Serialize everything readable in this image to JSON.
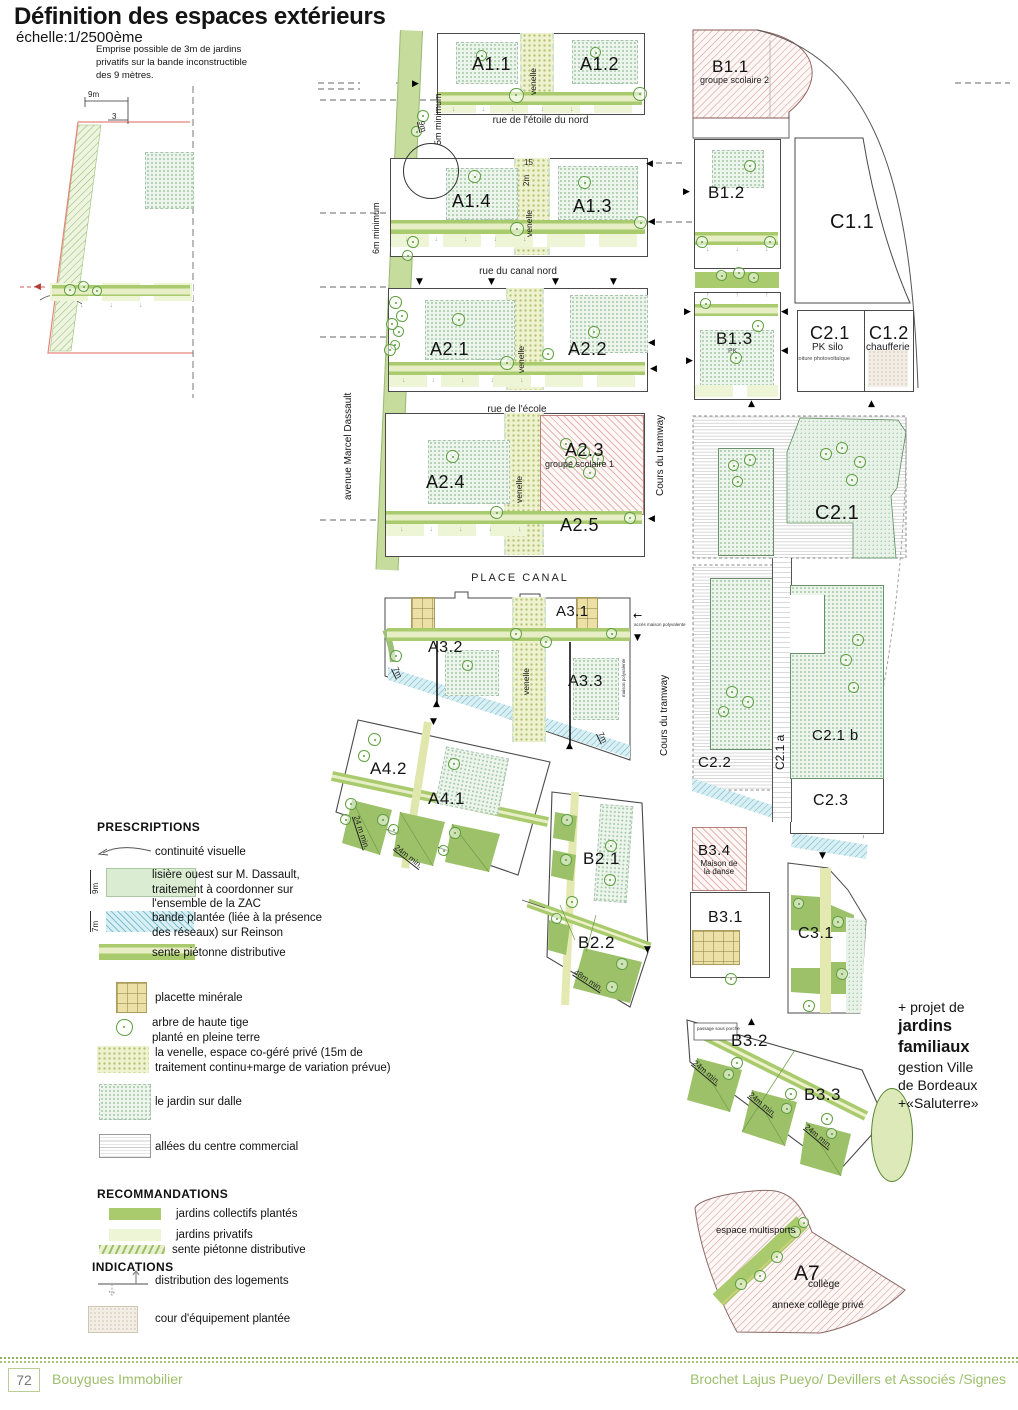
{
  "header": {
    "title": "Définition des espaces extérieurs",
    "scale": "échelle:1/2500ème",
    "note": "Emprise possible de 3m de jardins\nprivatifs sur la bande inconstructible\ndes 9 mètres."
  },
  "inset": {
    "dim_9m": "9m",
    "dim_3": "3"
  },
  "plan": {
    "venelle_label": "venelle",
    "streets": {
      "etoile": "rue de l'étoile du nord",
      "canal": "rue du canal nord",
      "ecole": "rue de l'école",
      "place": "PLACE CANAL",
      "dassault": "avenue Marcel Dassault",
      "tramway": "Cours du tramway"
    },
    "dims": {
      "min5": "5m minimum",
      "min6": "6m minimum",
      "m9": "9m",
      "v15": "15",
      "v2m": "2m",
      "m7": "7m",
      "d24a": "24 m min.",
      "d24b": "24m min.",
      "d48": "48m min."
    },
    "zones": {
      "a11": "A1.1",
      "a12": "A1.2",
      "b11": "B1.1",
      "b11_sub": "groupe scolaire 2",
      "a14": "A1.4",
      "a13": "A1.3",
      "b12": "B1.2",
      "c11": "C1.1",
      "a21": "A2.1",
      "a22": "A2.2",
      "b13": "B1.3",
      "b13_sub": "PK",
      "c21s": "C2.1",
      "c21s_sub1": "PK silo",
      "c21s_sub2": "toiture photovoltaïque",
      "c12": "C1.2",
      "c12_sub": "chaufferie",
      "a24": "A2.4",
      "a23": "A2.3",
      "a23_sub": "groupe scolaire 1",
      "a25": "A2.5",
      "c21": "C2.1",
      "a31": "A3.1",
      "a32": "A3.2",
      "a33": "A3.3",
      "c22": "C2.2",
      "c21a": "C2.1 a",
      "c21b": "C2.1 b",
      "c23": "C2.3",
      "a42": "A4.2",
      "a41": "A4.1",
      "b21": "B2.1",
      "b22": "B2.2",
      "b34": "B3.4",
      "b34_sub": "Maison de\nla danse",
      "b31": "B3.1",
      "c31": "C3.1",
      "b32": "B3.2",
      "b33": "B3.3",
      "a7": "A7",
      "a7_sub1": "collège",
      "a7_sub2": "annexe collège privé",
      "multisports": "espace multisports"
    },
    "tiny": {
      "acces": "accès maison\npolyvalente",
      "maison": "maison polyvalente",
      "passage": "passage sous\nporche"
    },
    "icons": {
      "tri_up": "▲",
      "tri_down": "▼",
      "tri_left": "◀",
      "tri_right": "▶",
      "arrow_left": "←",
      "down5": "↓↓↓↓↓",
      "down3": "↓↓↓",
      "up3": "↑↑↑"
    }
  },
  "side_note": {
    "l1": "+ projet de",
    "l2": "jardins",
    "l3": "familiaux",
    "l4": "gestion Ville",
    "l5": "de Bordeaux",
    "l6": "+«Saluterre»"
  },
  "legend": {
    "prescriptions_title": "PRESCRIPTIONS",
    "prescriptions": [
      {
        "label": "continuité visuelle"
      },
      {
        "dim": "9m",
        "label": "lisière ouest sur M. Dassault,\ntraitement à coordonner sur\nl'ensemble de la ZAC"
      },
      {
        "dim": "7m",
        "label": "bande plantée (liée à la présence\ndes réseaux) sur Reinson"
      },
      {
        "label": "sente piétonne distributive"
      },
      {
        "label": "placette minérale"
      },
      {
        "label": "arbre de haute tige\nplanté en pleine terre"
      },
      {
        "label": "la venelle, espace co-géré privé (15m de\ntraitement continu+marge de variation prévue)"
      },
      {
        "label": "le jardin sur dalle"
      },
      {
        "label": "allées du centre commercial"
      }
    ],
    "recommandations_title": "RECOMMANDATIONS",
    "recommandations": [
      {
        "label": "jardins collectifs plantés"
      },
      {
        "label": "jardins privatifs"
      },
      {
        "label": "sente piétonne distributive"
      }
    ],
    "indications_title": "INDICATIONS",
    "indications": [
      {
        "label": "distribution des  logements"
      },
      {
        "label": "cour d'équipement plantée"
      }
    ]
  },
  "footer": {
    "page": "72",
    "left": "Bouygues Immobilier",
    "right": "Brochet Lajus Pueyo/ Devillers et Associés /Signes"
  },
  "colors": {
    "collectif_green": "#a9cb6e",
    "privatif_green": "#eef4d6",
    "venelle_yellow": "#eef2cf",
    "blue_band": "#d8eff4",
    "red_hatch": "#d27d78",
    "footer_green": "#9cbf6b"
  }
}
